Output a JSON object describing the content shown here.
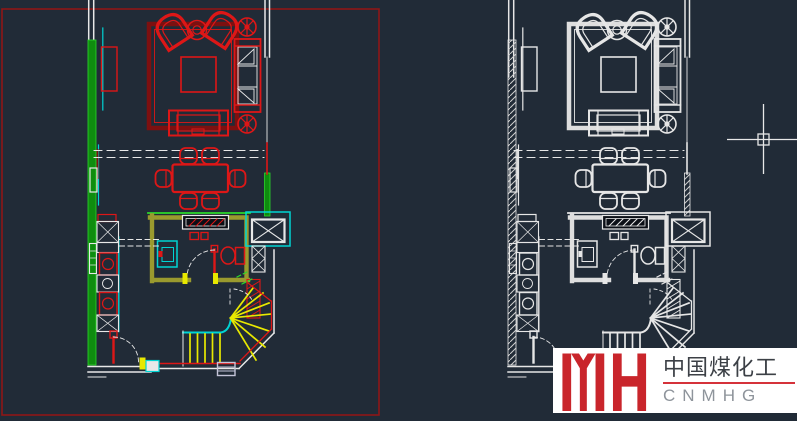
{
  "window": {
    "width": 797,
    "height": 421,
    "background": "#212b37"
  },
  "drawing": {
    "selection_rectangle_color": "#8e1717",
    "crosshair_color": "#e8e8e8",
    "palette_colored": {
      "white": "#e8e8e8",
      "red": "#dd1717",
      "rug": "#7d1010",
      "green": "#2bd82b",
      "greenfill": "#0f8c0f",
      "olive": "#9a9a2e",
      "cyan": "#00d4d4",
      "yellow": "#e8e800",
      "gray": "#c4c4d8"
    },
    "palette_mono": {
      "white": "#e6e6e6",
      "red": "#e6e6e6",
      "rug": "#dedede",
      "green": "#e6e6e6",
      "greenfill": "url(#hatch)",
      "olive": "#dedede",
      "cyan": "#e6e6e6",
      "yellow": "#e6e6e6",
      "gray": "#cfcfcf"
    }
  },
  "watermark": {
    "letters": "YH",
    "title": "中国煤化工",
    "subtitle": "CNMHG",
    "box_background": "#ffffff",
    "letters_color": "#c9252b",
    "title_color": "#3c4046",
    "underline_color": "#d5323a",
    "subtitle_color": "#8e949b"
  }
}
